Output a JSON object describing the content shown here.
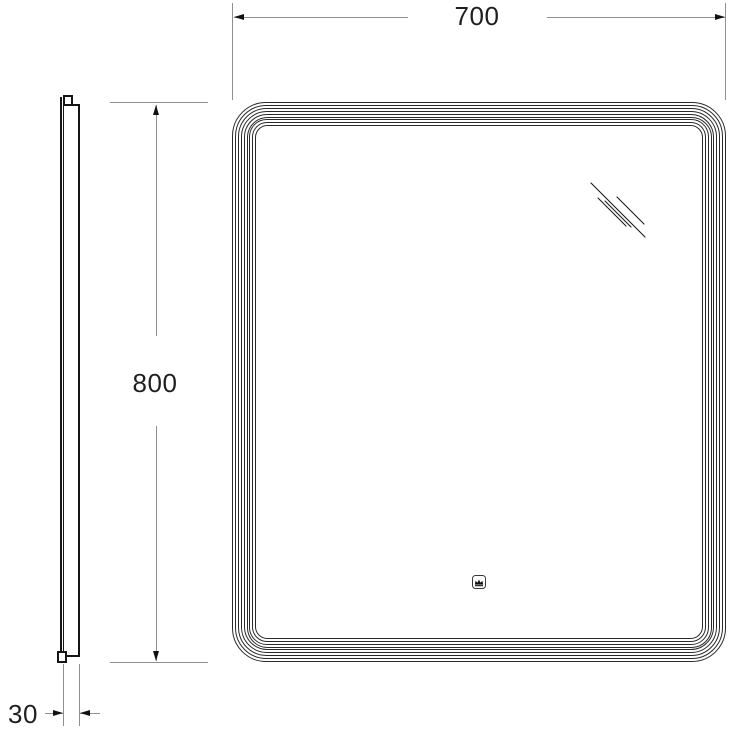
{
  "colors": {
    "background": "#ffffff",
    "outline": "#2a2a2a",
    "profile": "#151515",
    "dimension_line": "#8f8f8f",
    "arrow": "#111111",
    "text": "#1f1f1f"
  },
  "front_view": {
    "frame_line_count": 9,
    "shine_icon": "mirror-shine-icon",
    "touch_sensor_icon": "crown-icon"
  },
  "side_view": {
    "parts": [
      "glass-panel",
      "body",
      "top-bracket",
      "bottom-bracket"
    ]
  },
  "dimensions": {
    "width": {
      "label": "700"
    },
    "height": {
      "label": "800"
    },
    "depth": {
      "label": "30"
    }
  }
}
